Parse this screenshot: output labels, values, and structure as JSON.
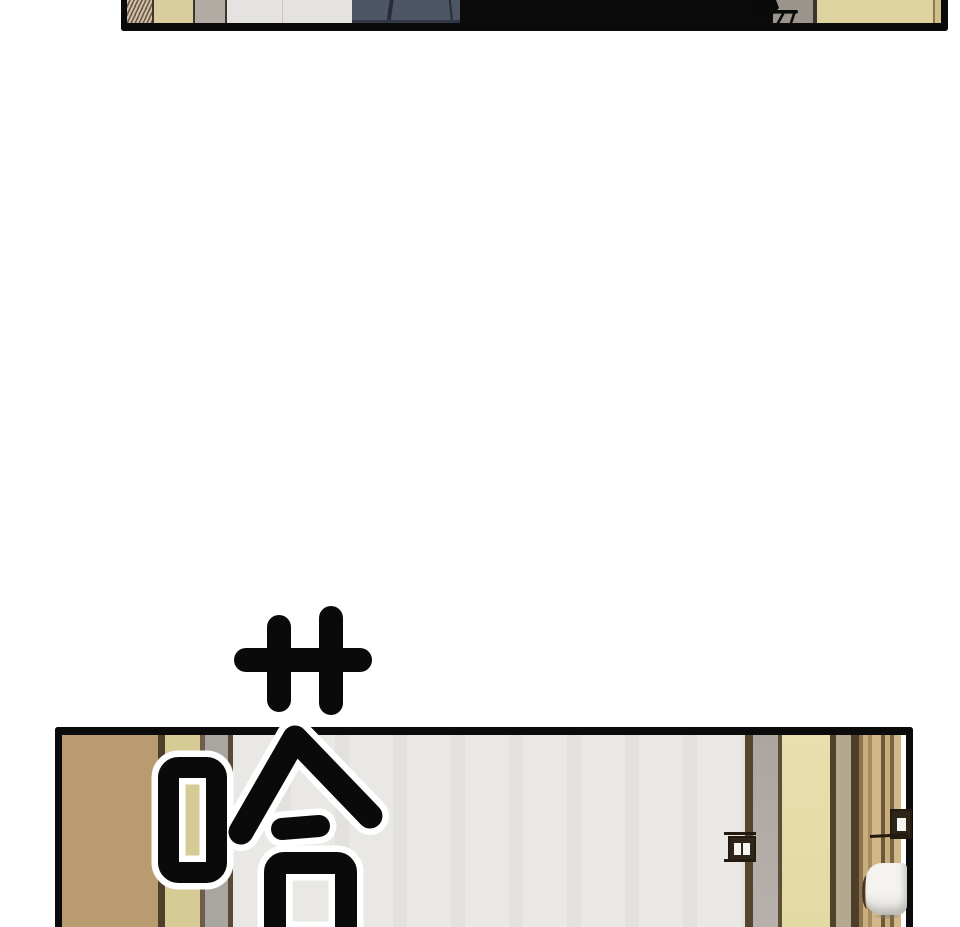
{
  "meta": {
    "page_type": "webtoon comic page",
    "width_px": 960,
    "height_px": 927
  },
  "sfx": {
    "glyph": "哈",
    "label": "hand-drawn sound effect 'HA' (laugh/gasp), black ink with white outline",
    "emphasis_marks": "卄-shaped motion tick marks above the glyph",
    "ink": "#0a0a0a",
    "outline": "#ffffff"
  },
  "panels": {
    "top": {
      "label": "cropped bottom sliver of an interior scene with tan walls, gray pillar, dark navy clothing and a black silhhouette mass",
      "alt": "top panel sliver"
    },
    "bottom": {
      "label": "interior doorway: tan wall, khaki pillar, light gray wall, open door edge with hinges and white door handle",
      "alt": "bottom doorway panel"
    }
  },
  "theme": {
    "paper": "#ffffff",
    "ink": "#0b0b0b",
    "sfx-ink": "#0a0a0a",
    "sfx-outline": "#ffffff",
    "tp-hatch-bg": "#cfc1ab",
    "tp-hatch-line": "#6f5742",
    "tp-khaki": "#d9cd9e",
    "tp-gray": "#b2aba4",
    "tp-white": "#e5e3df",
    "tp-navy": "#4e5565",
    "tp-navy-dark": "#272c38",
    "tp-gray2": "#9a948c",
    "tp-khaki2": "#ded29f",
    "tp-tanstrip": "#d2bf8a",
    "bp-tan": "#b89c70",
    "bp-dark1": "#4e3f2d",
    "bp-khaki": "#d6ca95",
    "bp-gray": "#a9a5a1",
    "bp-wall": "#e9e8e5",
    "bp-frame": "#55452f",
    "bp-doorgray": "#b6b1ac",
    "bp-cream": "#e3d9a2",
    "bp-beige": "#b3a98f",
    "hinge": "#2f2418",
    "knob": "#f4f3f0"
  }
}
